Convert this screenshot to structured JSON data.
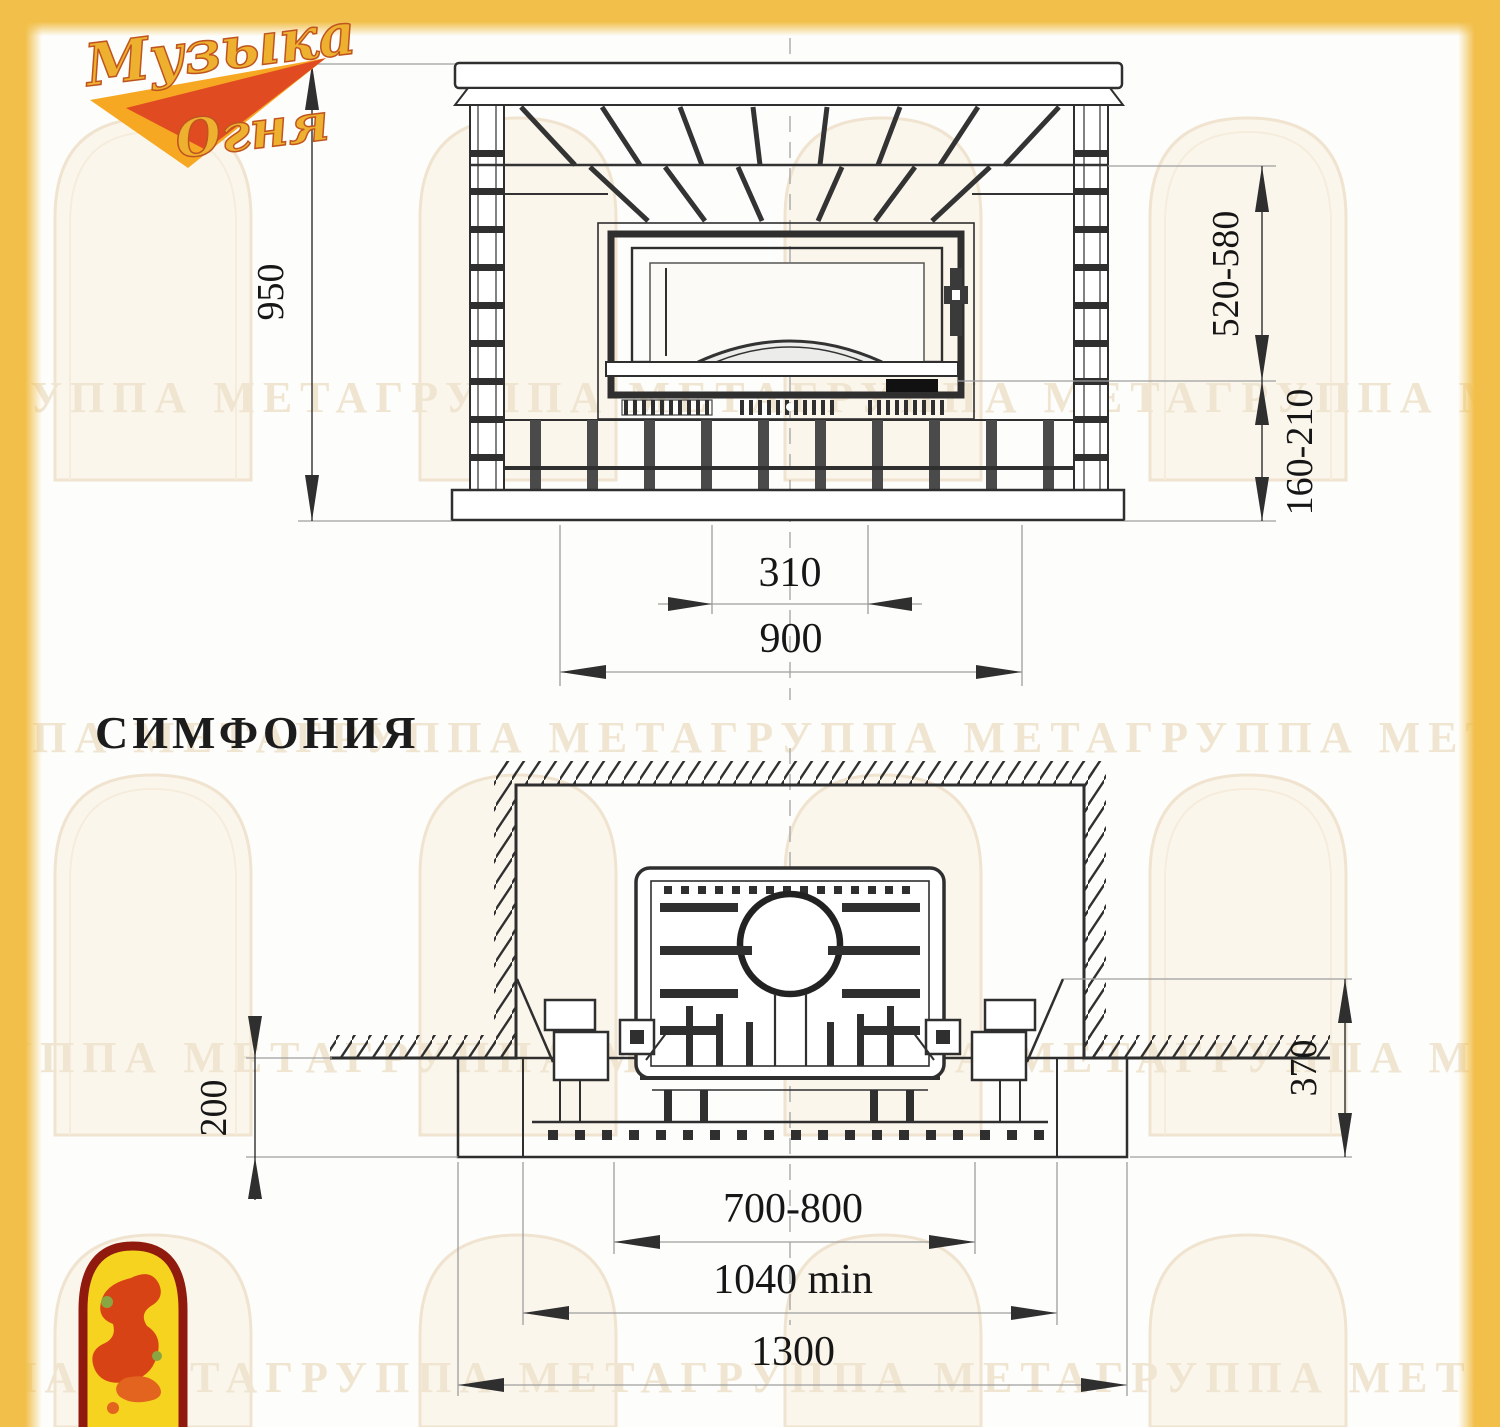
{
  "page": {
    "background": "#fdfdfb",
    "accent_yellow": "#f1bf4a"
  },
  "logo": {
    "line1": "Музыка",
    "line2": "Огня",
    "colors": {
      "script": "#eeb02f",
      "outline": "#c0541f",
      "swoosh_orange": "#f7a823",
      "swoosh_red": "#dd3b22"
    }
  },
  "title": "СИМФОНИЯ",
  "watermark": {
    "row_text": "ГРУППА МЕТАГРУППА МЕТАГРУППА МЕТАГРУППА МЕТАГРУППА МЕТА",
    "color": "#f0e5d1"
  },
  "front_view": {
    "dims": {
      "overall_height": "950",
      "firebox_opening_height": "520-580",
      "hearth_gap_height": "160-210",
      "ash_niche_width": "310",
      "body_width": "900"
    }
  },
  "plan_view": {
    "dims": {
      "hearth_front_depth": "200",
      "side_wall_depth": "370",
      "insert_opening_width": "700-800",
      "niche_min_width": "1040 min",
      "base_total_width": "1300"
    }
  },
  "emblem": {
    "colors": {
      "border": "#8f1a0d",
      "fill": "#f6d31f",
      "flame": "#d84315"
    }
  }
}
